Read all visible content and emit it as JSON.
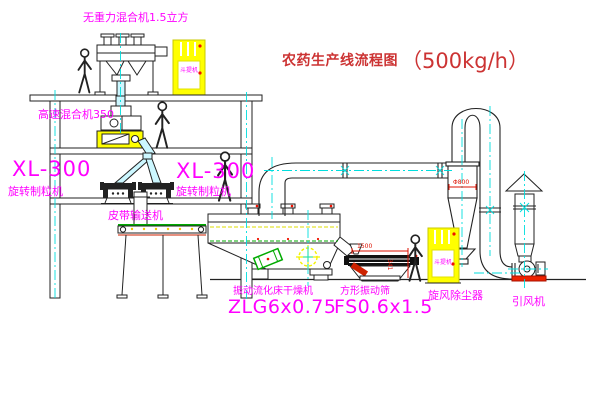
{
  "title": {
    "name": "农药生产线流程图",
    "capacity": "（500kg/h）"
  },
  "labels": {
    "gravity_mixer": "无重力混合机1.5立方",
    "high_speed_mixer": "高速混合机350",
    "granulator_left": {
      "model": "XL-300",
      "name": "旋转制粒机"
    },
    "granulator_right": {
      "model": "XL-300",
      "name": "旋转制粒机"
    },
    "belt_conveyor": "皮带输送机",
    "dryer": {
      "name": "振动流化床干燥机",
      "model": "ZLG6x0.75"
    },
    "sieve": {
      "name": "方形振动筛",
      "model": "FS0.6x1.5"
    },
    "cyclone": "旋风除尘器",
    "fan": "引风机",
    "bucket_elevator": "斗提机"
  },
  "dimensions": {
    "sieve_width": "1500",
    "sieve_side": "341",
    "cyclone_dia": "Φ800"
  },
  "colors": {
    "label_magenta": "#ff00ff",
    "title_red": "#cc3333",
    "centerline_cyan": "#00dede",
    "highlight_yellow": "#ffff00",
    "material_green": "#00aa00",
    "alert_red": "#ee1100"
  }
}
